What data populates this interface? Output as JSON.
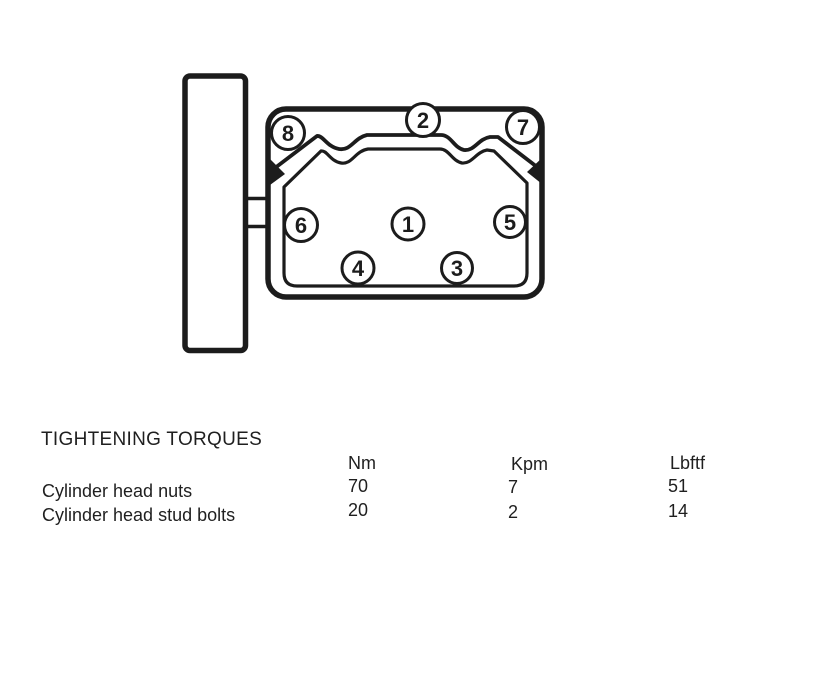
{
  "page": {
    "background": "#ffffff",
    "ink_color": "#1c1c1c"
  },
  "diagram": {
    "bolts": [
      {
        "label": "1",
        "cx": 408,
        "cy": 224,
        "r": 16
      },
      {
        "label": "2",
        "cx": 423,
        "cy": 120,
        "r": 16.5
      },
      {
        "label": "3",
        "cx": 457,
        "cy": 268,
        "r": 15.5
      },
      {
        "label": "4",
        "cx": 358,
        "cy": 268,
        "r": 16
      },
      {
        "label": "5",
        "cx": 510,
        "cy": 222,
        "r": 15.5
      },
      {
        "label": "6",
        "cx": 301,
        "cy": 225,
        "r": 16.5
      },
      {
        "label": "7",
        "cx": 523,
        "cy": 127,
        "r": 16.5
      },
      {
        "label": "8",
        "cx": 288,
        "cy": 133,
        "r": 16.5
      }
    ]
  },
  "torque_table": {
    "title": "TIGHTENING TORQUES",
    "columns": [
      "Nm",
      "Kpm",
      "Lbftf"
    ],
    "rows": [
      {
        "label": "Cylinder head nuts",
        "values": [
          "70",
          "7",
          "51"
        ]
      },
      {
        "label": "Cylinder head stud bolts",
        "values": [
          "20",
          "2",
          "14"
        ]
      }
    ]
  }
}
